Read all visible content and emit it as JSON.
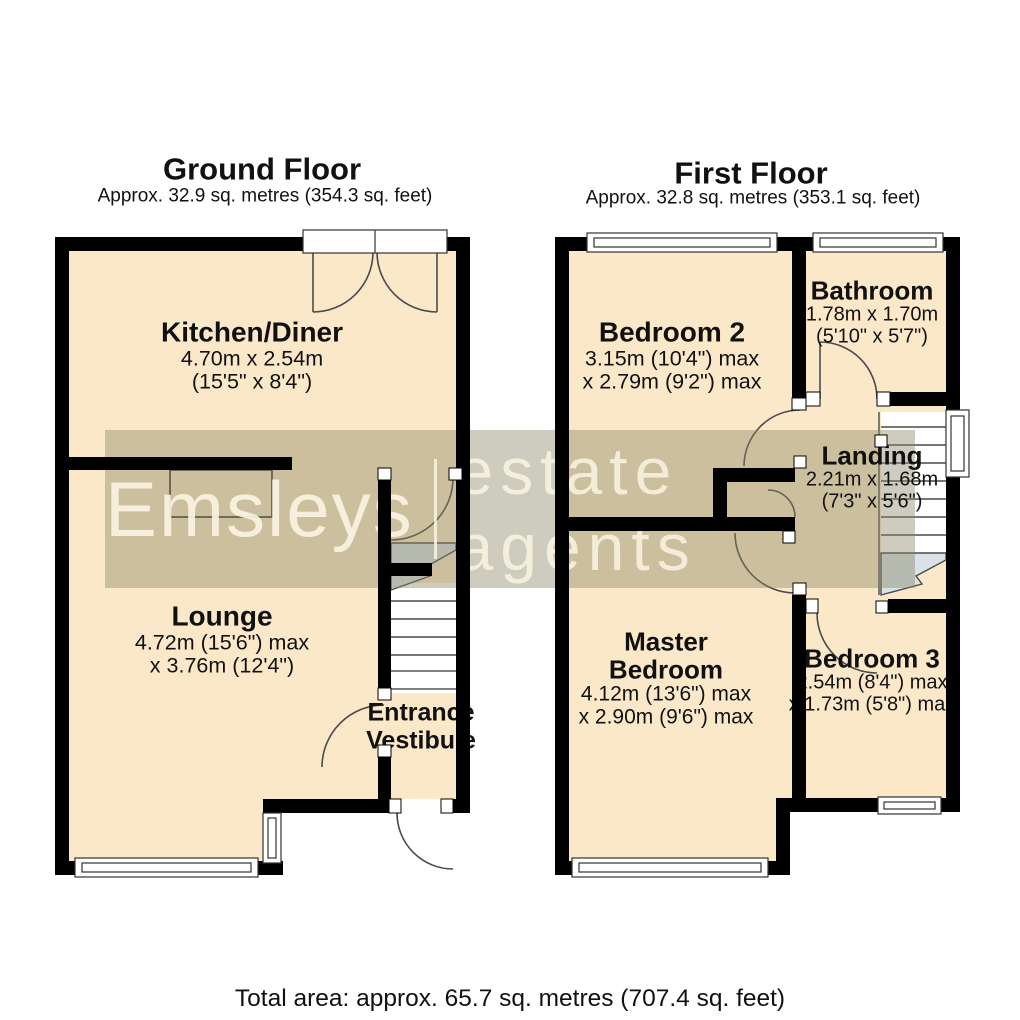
{
  "watermark": {
    "brand": "Emsleys",
    "suffix": "estate agents"
  },
  "floors": [
    {
      "id": "ground",
      "title": "Ground Floor",
      "subtitle": "Approx. 32.9 sq. metres (354.3 sq. feet)",
      "rooms": [
        {
          "key": "kitchen",
          "name": "Kitchen/Diner",
          "dims": [
            "4.70m x 2.54m",
            "(15'5\" x 8'4\")"
          ]
        },
        {
          "key": "lounge",
          "name": "Lounge",
          "dims": [
            "4.72m (15'6\") max",
            "x 3.76m (12'4\")"
          ]
        },
        {
          "key": "vestibule",
          "name": "Entrance Vestibule",
          "name_lines": [
            "Entrance",
            "Vestibule"
          ],
          "dims": []
        }
      ]
    },
    {
      "id": "first",
      "title": "First Floor",
      "subtitle": "Approx. 32.8 sq. metres (353.1 sq. feet)",
      "rooms": [
        {
          "key": "bedroom2",
          "name": "Bedroom 2",
          "dims": [
            "3.15m (10'4\") max",
            "x 2.79m (9'2\") max"
          ]
        },
        {
          "key": "bathroom",
          "name": "Bathroom",
          "dims": [
            "1.78m x 1.70m",
            "(5'10\" x 5'7\")"
          ]
        },
        {
          "key": "landing",
          "name": "Landing",
          "dims": [
            "2.21m x 1.68m",
            "(7'3\" x 5'6\")"
          ]
        },
        {
          "key": "master",
          "name": "Master Bedroom",
          "name_lines": [
            "Master",
            "Bedroom"
          ],
          "dims": [
            "4.12m (13'6\") max",
            "x 2.90m (9'6\") max"
          ]
        },
        {
          "key": "bedroom3",
          "name": "Bedroom 3",
          "dims": [
            "2.54m (8'4\") max",
            "x 1.73m (5'8\") max"
          ]
        }
      ]
    }
  ],
  "footer": {
    "total_area": "Total area: approx. 65.7 sq. metres (707.4 sq. feet)"
  },
  "colors": {
    "room_fill": "#fbe8c9",
    "wall": "#000000",
    "stair_fill": "#d9e2e6",
    "line": "#4a4a4a",
    "watermark_band": "rgba(136,133,101,0.42)",
    "watermark_text": "rgba(250,243,226,0.9)"
  }
}
